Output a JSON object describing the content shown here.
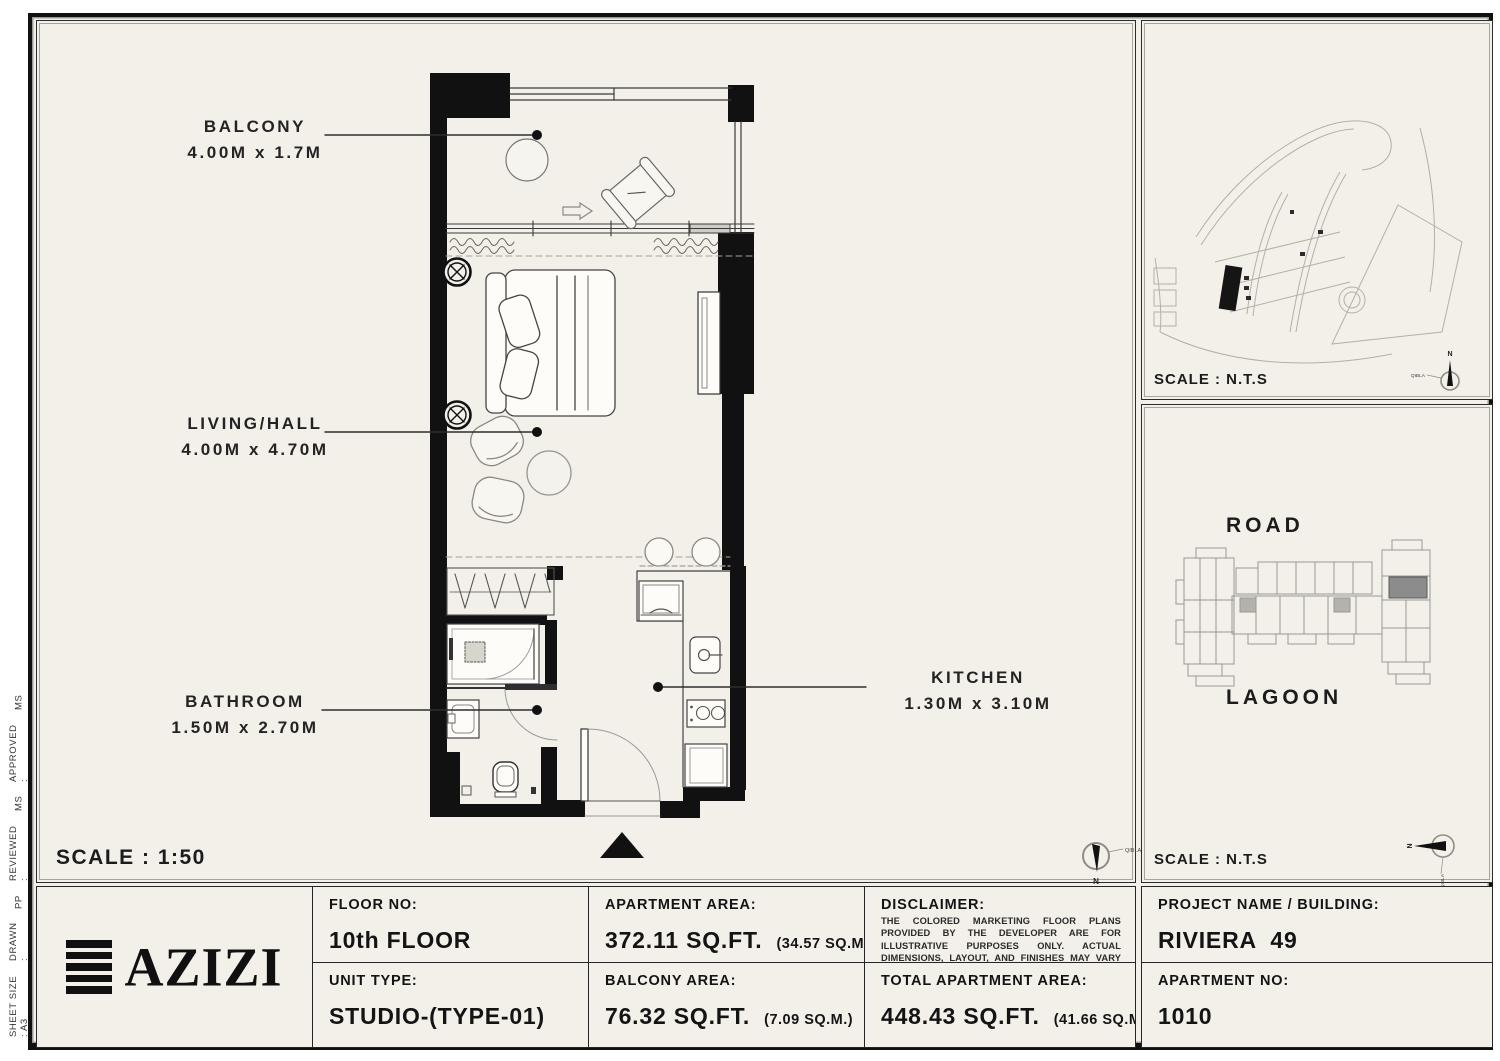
{
  "margin_info": {
    "sheet_size": "SHEET SIZE : A3",
    "drawn_label": "DRAWN :",
    "drawn_value": "PP",
    "reviewed_label": "REVIEWED :",
    "reviewed_value": "MS",
    "approved_label": "APPROVED :",
    "approved_value": "MS"
  },
  "floor_plan": {
    "labels": {
      "balcony": {
        "name": "BALCONY",
        "dims": "4.00M x 1.7M"
      },
      "living": {
        "name": "LIVING/HALL",
        "dims": "4.00M x 4.70M"
      },
      "bathroom": {
        "name": "BATHROOM",
        "dims": "1.50M x 2.70M"
      },
      "kitchen": {
        "name": "KITCHEN",
        "dims": "1.30M x 3.10M"
      }
    },
    "scale": "SCALE : 1:50"
  },
  "compass": {
    "n": "N",
    "qibla": "QIBLA"
  },
  "site_map": {
    "scale": "SCALE : N.T.S"
  },
  "key_plan": {
    "road": "ROAD",
    "lagoon": "LAGOON",
    "scale": "SCALE : N.T.S"
  },
  "title_block": {
    "logo_text": "AZIZI",
    "floor_label": "FLOOR NO:",
    "floor_value": "10th FLOOR",
    "unit_label": "UNIT TYPE:",
    "unit_value": "STUDIO-(TYPE-01)",
    "apt_area_label": "APARTMENT AREA:",
    "apt_area_value": "372.11 SQ.FT.",
    "apt_area_metric": "(34.57 SQ.M.)",
    "balc_area_label": "BALCONY AREA:",
    "balc_area_value": "76.32 SQ.FT.",
    "balc_area_metric": "(7.09 SQ.M.)",
    "disclaimer_label": "DISCLAIMER:",
    "disclaimer_text": "THE COLORED MARKETING FLOOR PLANS PROVIDED BY THE DEVELOPER ARE FOR ILLUSTRATIVE PURPOSES ONLY. ACTUAL DIMENSIONS, LAYOUT, AND FINISHES MAY VARY FROM THOSE DEPICTED IN THE PLANS. FURNITURE, FIXTURES, AND EQUIPMENT SHOWN IN THE PLANS ARE FOR DECORATIVE PURPOSES ONLY AND ARE NOT INCLUDED IN THE PURCHASE OR LEASE OF THE PROPERTY. THE DEVELOPER RESERVES THE RIGHT TO MAKE MODIFICATIONS, REVISIONS, AND CHANGES TO THE FLOOR PLANS, SPECIFICATIONS, AND FEATURES WITHOUT PRIOR NOTICE.",
    "total_label": "TOTAL APARTMENT AREA:",
    "total_value": "448.43 SQ.FT.",
    "total_metric": "(41.66 SQ.M.)",
    "project_label": "PROJECT NAME / BUILDING:",
    "project_value": "RIVIERA  49",
    "apt_no_label": "APARTMENT NO:",
    "apt_no_value": "1010"
  }
}
